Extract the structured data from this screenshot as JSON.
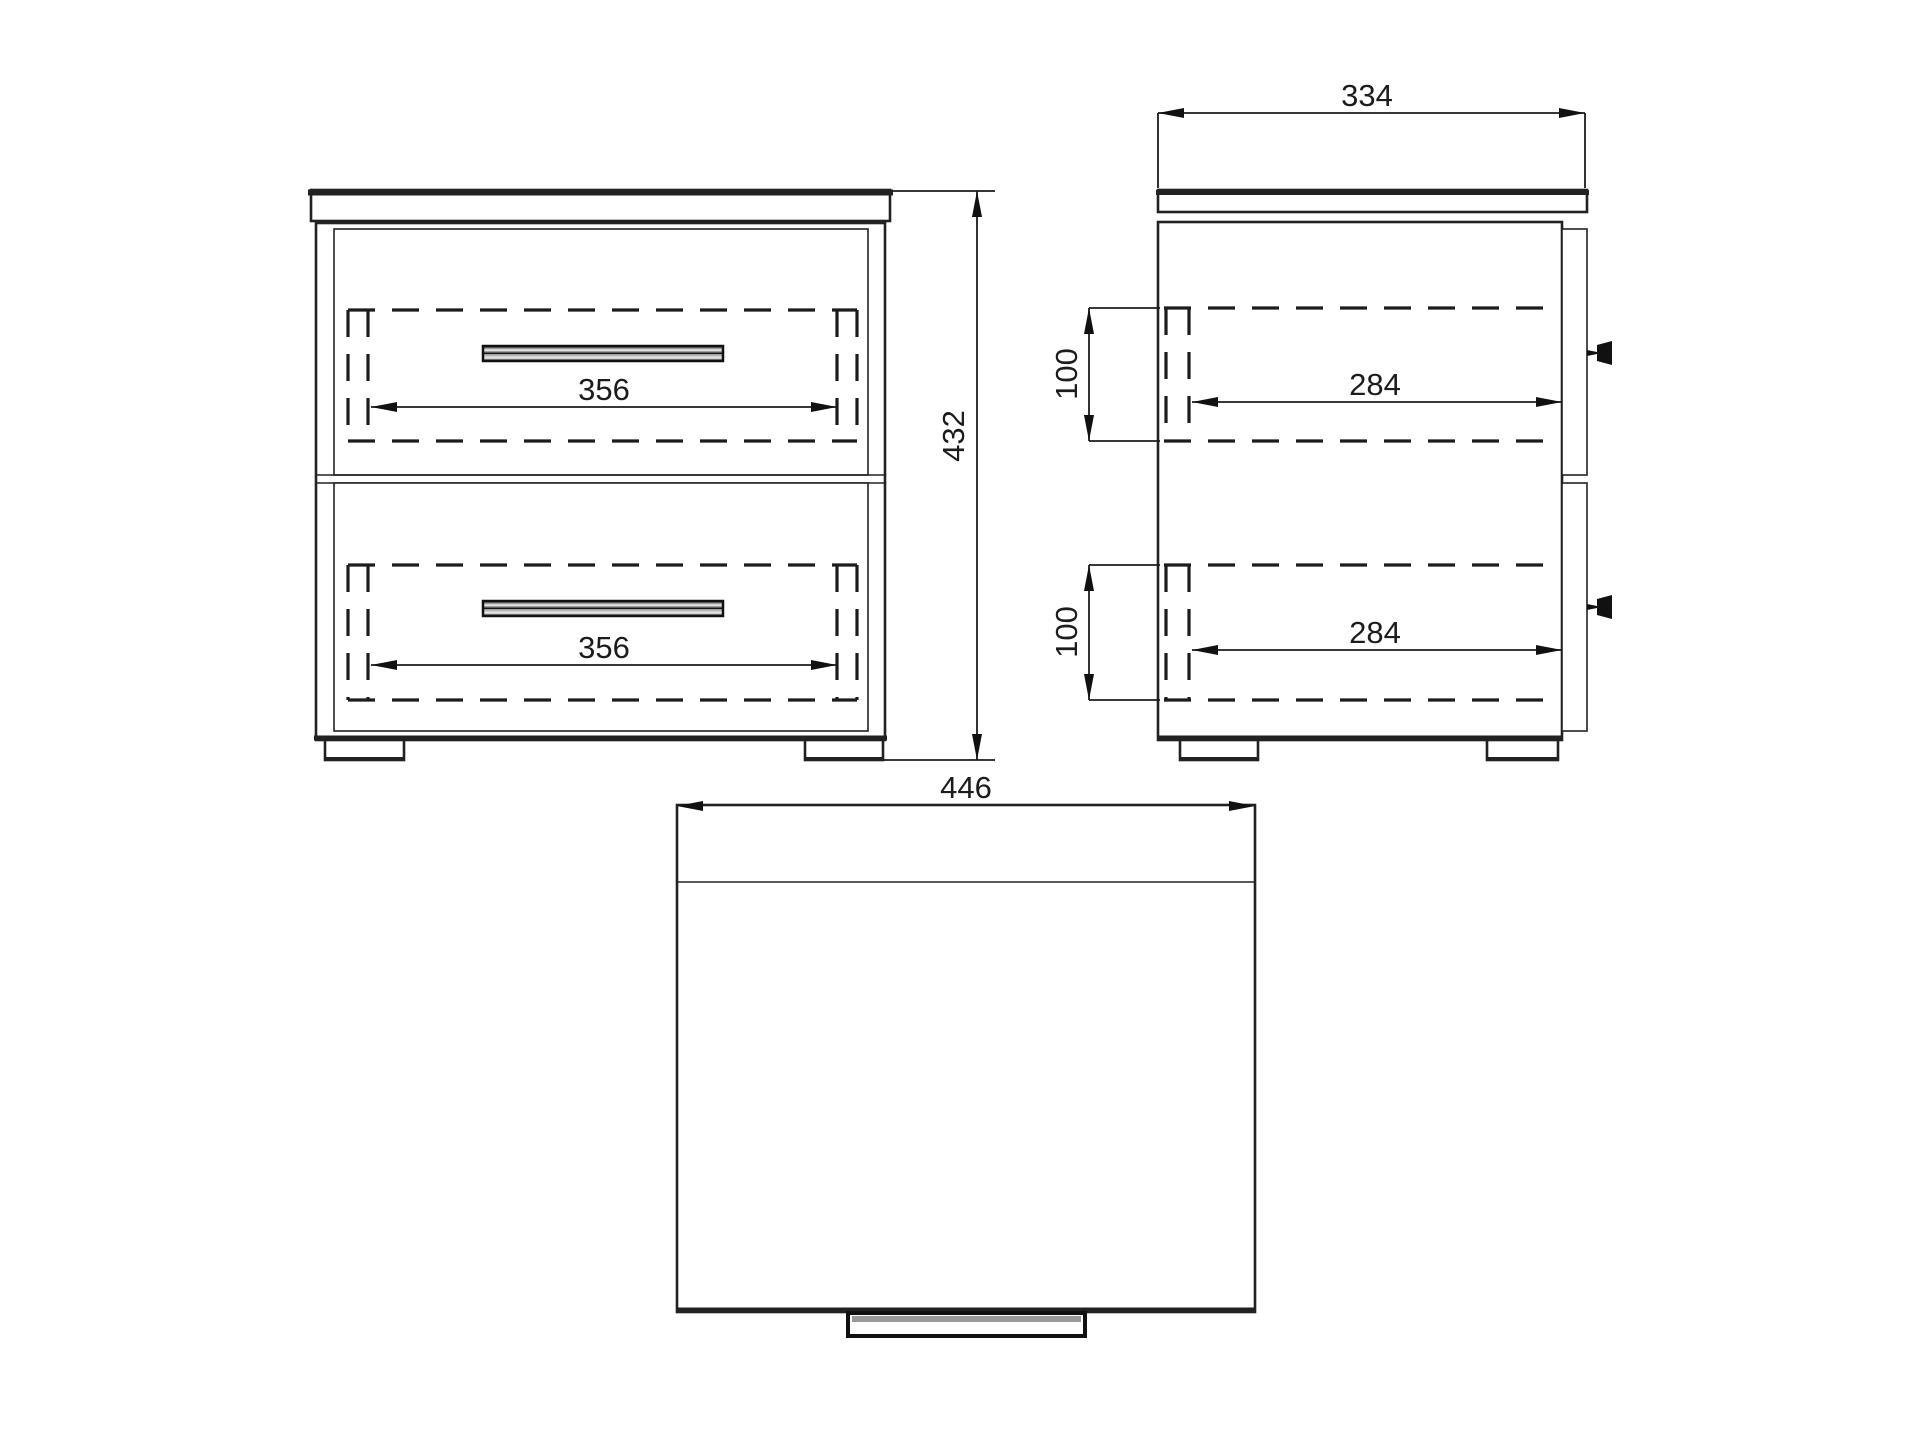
{
  "page": {
    "background": "#ffffff",
    "line_color": "#1c1c1c",
    "description": "Technical dimension drawing of a two-drawer bedside cabinet, three orthographic views"
  },
  "views": {
    "front": {
      "name": "front-view",
      "dims": {
        "drawer1_width": "356",
        "drawer2_width": "356",
        "overall_height": "432"
      }
    },
    "side": {
      "name": "side-view",
      "dims": {
        "overall_depth": "334",
        "drawer1_height": "100",
        "drawer2_height": "100",
        "drawer1_depth": "284",
        "drawer2_depth": "284"
      }
    },
    "top": {
      "name": "top-view",
      "dims": {
        "overall_width": "446"
      }
    }
  }
}
